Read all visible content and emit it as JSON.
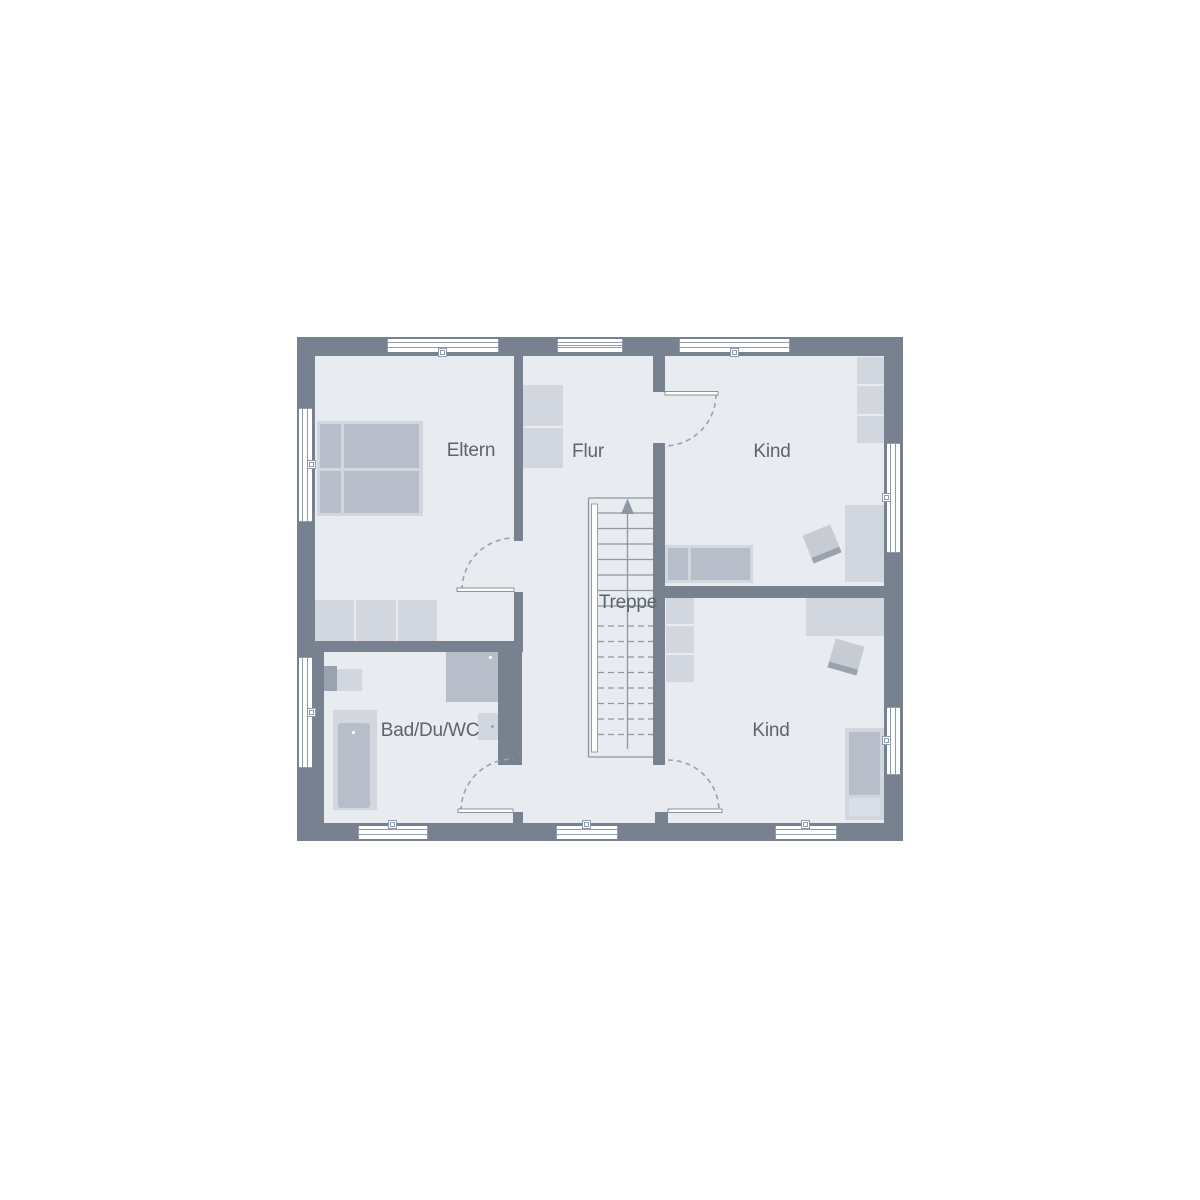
{
  "plan": {
    "type": "floor-plan",
    "rooms": [
      {
        "id": "eltern",
        "label": "Eltern"
      },
      {
        "id": "flur",
        "label": "Flur"
      },
      {
        "id": "kind-top",
        "label": "Kind"
      },
      {
        "id": "kind-bottom",
        "label": "Kind"
      },
      {
        "id": "bad",
        "label": "Bad/Du/WC"
      },
      {
        "id": "treppe",
        "label": "Treppe"
      }
    ],
    "symbols": [
      "double-bed-icon",
      "single-bed-icon",
      "wardrobe-icon",
      "cabinet-icon",
      "desk-icon",
      "chair-icon",
      "bathtub-icon",
      "sink-icon",
      "shower-icon",
      "wc-icon",
      "stairs-icon",
      "stairs-up-arrow-icon",
      "door-swing-icon",
      "window-icon"
    ],
    "colors": {
      "wall": "#78818f",
      "floor": "#e8ebf0",
      "furniture_light": "#d2d6de",
      "furniture_mid": "#b8bec9",
      "furniture_dark": "#9aa2b0",
      "line": "#929bab",
      "text": "#5c6470",
      "window": "#ffffff",
      "background": "#ffffff"
    }
  }
}
